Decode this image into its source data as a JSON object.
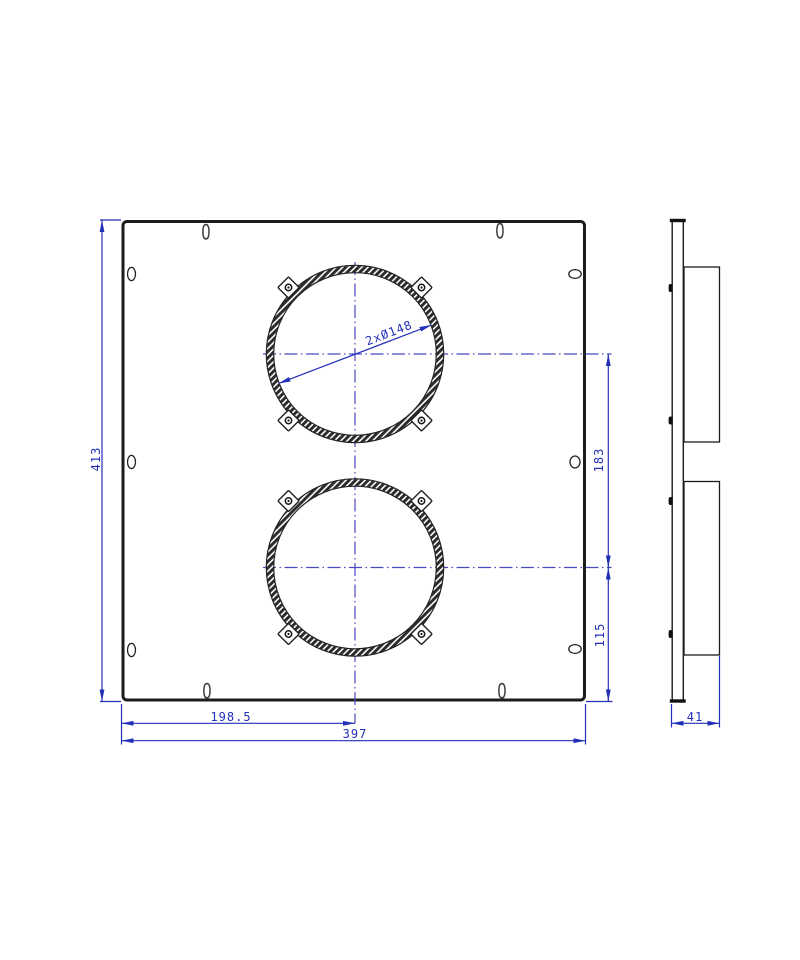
{
  "drawing": {
    "zero_markers": {
      "top_left": "0",
      "top_right": "0",
      "bottom_left": "0",
      "bottom_right": "0"
    },
    "dimensions": {
      "overall_height": "413",
      "hole_center_from_left": "198.5",
      "overall_width": "397",
      "hole_center_spacing": "183",
      "lower_hole_center_from_bottom": "115",
      "side_depth": "41",
      "hole_diameter": "2xØ148"
    },
    "colors": {
      "dimension_blue": "#2230b8",
      "centerline_blue": "#4a4ac0",
      "outline_black": "#1c1c1c"
    }
  }
}
